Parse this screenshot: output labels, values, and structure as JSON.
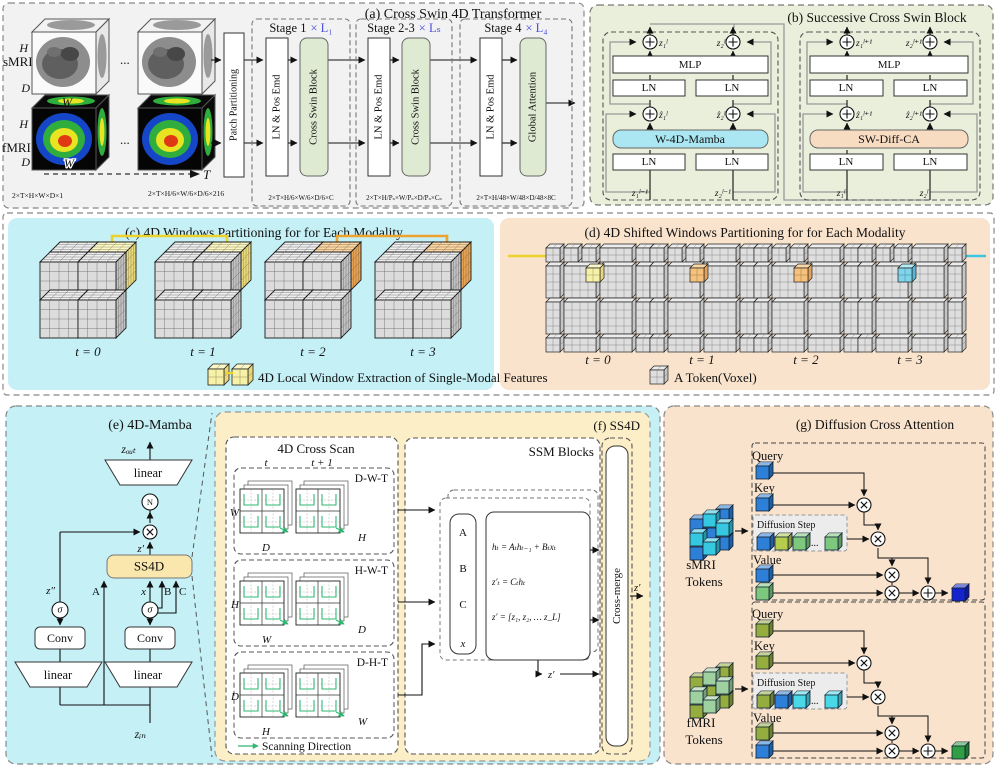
{
  "colors": {
    "panel_a_bg": "#f2f2f2",
    "panel_b_bg": "#e9efdb",
    "green_block": "#dfead2",
    "cyan_bg": "#c4f0f6",
    "peach_bg": "#f9e3cd",
    "yellow_bg": "#fcefc8",
    "ss4d_box": "#fae7ad",
    "mamba_box": "#abe7f2",
    "diffca_box": "#f8dcc2",
    "stage_mult_blue": "#4a50e0",
    "window_yellow": "#f7f1a8",
    "window_orange": "#f6c17c",
    "shift_cyan": "#7fd4ea",
    "line_yellow": "#ecd32b",
    "line_orange": "#efa32f",
    "line_cyan": "#3ec6dd",
    "smri_token_blue": "#2d7fd8",
    "smri_token_cyan": "#35c8e0",
    "fmri_token_olive": "#95ad3e",
    "fmri_token_green": "#9fd0a0",
    "out_cube_blue": "#1423cb",
    "out_cube_green": "#2f9e44",
    "scan_green": "#2eb872"
  },
  "panel_a": {
    "title": "(a) Cross Swin 4D Transformer",
    "smri": "sMRI",
    "fmri": "fMRI",
    "h": "H",
    "d": "D",
    "w": "W",
    "dots": "...",
    "t": "T",
    "d im_note": "",
    "dim_input": "2×T×H×W×D×1",
    "dim_patch": "2×T×H/6×W/6×D/6×216",
    "patch": "Patch Partitioning",
    "stages": [
      {
        "title": "Stage 1",
        "mult": "× L₁",
        "ln": "LN & Pos Emd",
        "block": "Cross Swin Block",
        "dim": "2×T×H/6×W/6×D/6×C"
      },
      {
        "title": "Stage 2-3",
        "mult": "× Lₛ",
        "ln": "LN & Pos Emd",
        "block": "Cross Swin Block",
        "dim": "2×T×H/Pₛ×W/Pₛ×D/Pₛ×Cₛ"
      },
      {
        "title": "Stage 4",
        "mult": "× L₄",
        "ln": "LN & Pos Emd",
        "block": "Global Attention",
        "dim": "2×T×H/48×W/48×D/48×8C"
      }
    ]
  },
  "panel_b": {
    "title": "(b) Successive Cross Swin Block",
    "blocks": [
      {
        "out1": "z₁ˡ",
        "out2": "z₂ˡ",
        "mlp": "MLP",
        "ln": "LN",
        "mid1": "ẑ₁ˡ",
        "mid2": "ẑ₂ˡ",
        "core": "W-4D-Mamba",
        "in1": "z₁ˡ⁻¹",
        "in2": "z₂ˡ⁻¹"
      },
      {
        "out1": "z₁ˡ⁺¹",
        "out2": "z₂ˡ⁺¹",
        "mlp": "MLP",
        "ln": "LN",
        "mid1": "ẑ₁ˡ⁺¹",
        "mid2": "ẑ₂ˡ⁺¹",
        "core": "SW-Diff-CA",
        "in1": "z₁ˡ",
        "in2": "z₂ˡ"
      }
    ]
  },
  "panel_c": {
    "title": "(c) 4D Windows Partitioning for for Each Modality",
    "t_labels": [
      "t = 0",
      "t = 1",
      "t = 2",
      "t = 3"
    ]
  },
  "panel_d": {
    "title": "(d) 4D Shifted Windows Partitioning for for Each Modality",
    "t_labels": [
      "t = 0",
      "t = 1",
      "t = 2",
      "t = 3"
    ]
  },
  "legend": {
    "window": "4D Local Window Extraction of Single-Modal Features",
    "token": "A Token(Voxel)"
  },
  "panel_e": {
    "title": "(e) 4D-Mamba",
    "z_out": "zₒᵤₜ",
    "linear": "linear",
    "n": "N",
    "z_prime": "z′",
    "ss4d": "SS4D",
    "a": "A",
    "x": "x",
    "b": "B",
    "c": "C",
    "z_dprime": "z″",
    "sigma": "σ",
    "conv": "Conv",
    "z_in": "zᵢₙ"
  },
  "panel_f": {
    "title": "(f) SS4D",
    "scan": {
      "title": "4D Cross Scan",
      "t": "t",
      "t1": "t + 1",
      "rows": [
        {
          "name": "D-W-T",
          "left": "W",
          "bottom": "D",
          "right": "H"
        },
        {
          "name": "H-W-T",
          "left": "H",
          "bottom": "W",
          "right": "D"
        },
        {
          "name": "D-H-T",
          "left": "D",
          "bottom": "H",
          "right": "W"
        }
      ],
      "legend": "Scanning Direction"
    },
    "ssm": {
      "title": "SSM Blocks",
      "a": "A",
      "b": "B",
      "c": "C",
      "x": "x",
      "eq1": "hₜ = Aₜhₜ₋₁ + Bₜxₜ",
      "eq2": "z′ₜ = Cₜhₜ",
      "eq3": "z′ = [z₁, z₂, … z_L]",
      "zp": "z′"
    },
    "merge": "Cross-merge",
    "out": "z′"
  },
  "panel_g": {
    "title": "(g) Diffusion Cross Attention",
    "blocks": [
      {
        "src1": "sMRI",
        "src2": "Tokens",
        "query": "Query",
        "key": "Key",
        "diff": "Diffusion Step",
        "dots": "...",
        "value": "Value"
      },
      {
        "src1": "fMRI",
        "src2": "Tokens",
        "query": "Query",
        "key": "Key",
        "diff": "Diffusion Step",
        "dots": "...",
        "value": "Value"
      }
    ]
  }
}
